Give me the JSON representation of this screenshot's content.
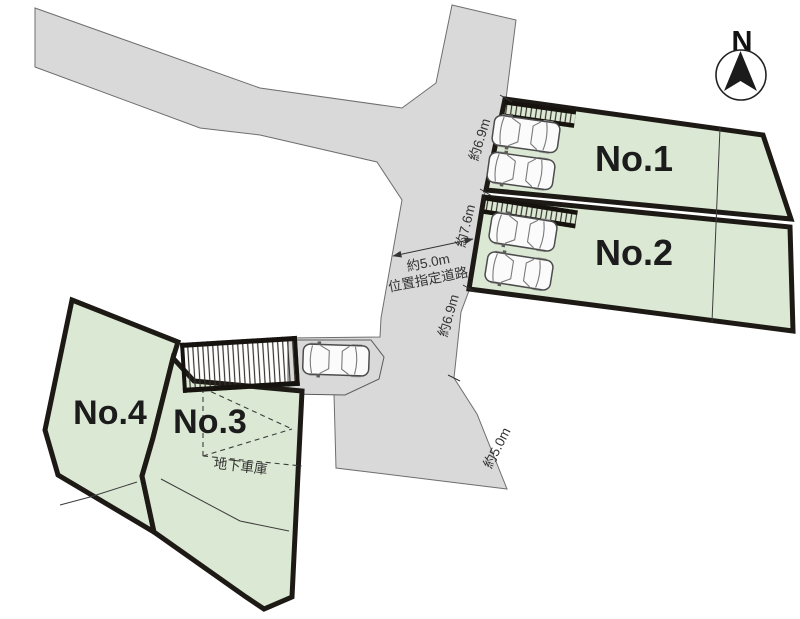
{
  "page": {
    "background": "#ffffff"
  },
  "colors": {
    "lot_fill": "#dbe8d4",
    "lot_border": "#1d1a15",
    "road_fill": "#d9d9d9",
    "road_border": "#6e6e6e",
    "label_text": "#1c1c1c",
    "dimension_text": "#333333"
  },
  "compass": {
    "north_label": "N"
  },
  "lots": {
    "no1": {
      "label": "No.1",
      "frontage_label": "約6.9m"
    },
    "no2": {
      "label": "No.2",
      "frontage_label": "約7.6m"
    },
    "no3": {
      "label": "No.3",
      "garage_label": "地下車庫"
    },
    "no4": {
      "label": "No.4"
    }
  },
  "road": {
    "width_label": "約5.0m",
    "type_label": "位置指定道路",
    "east_frontage_label": "約6.9m",
    "south_width_label": "約5.0m"
  }
}
